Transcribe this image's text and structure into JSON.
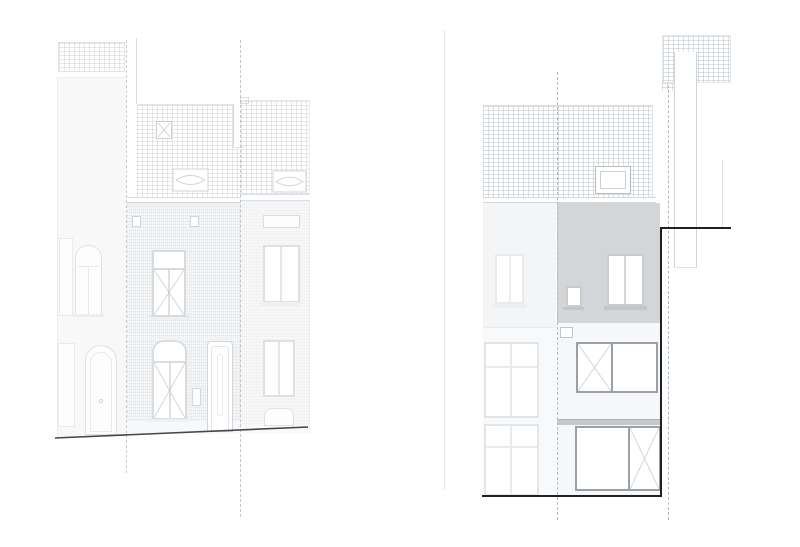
{
  "drawing": {
    "kind": "architectural-elevations",
    "views": [
      {
        "id": "street-elevation",
        "depicts": [
          "neighbor-house-left",
          "row-house-centre",
          "row-house-right",
          "tiled-roofs",
          "roof-window",
          "lens-dormer",
          "roof-chimney",
          "arched-windows",
          "entry-doors",
          "sloping-street-line",
          "dashed-parcel-boundaries"
        ]
      },
      {
        "id": "rear-elevation",
        "depicts": [
          "neighbor-brick-facade",
          "grey-rendered-upper-facade",
          "roof-skylight",
          "chimney-stack",
          "new-window-openings",
          "bold-extension-outline",
          "flat-ground-line",
          "dashed-parcel-boundaries"
        ]
      }
    ]
  },
  "colors": {
    "paper": "#ffffff",
    "tile-line": "#98a2aa52",
    "brick-line": "#98a2aa38",
    "faint-line": "#98a2aa1a",
    "edge": "#d9dcde",
    "edge-strong": "#c2c6c9",
    "frame-gray": "#9aa0a5",
    "render-gray": "#d4d5d6",
    "band-gray": "#c6c9cb",
    "sill-gray": "#c3c6c8",
    "glass-diag": "#bcc2c6",
    "ink": "#1f2022",
    "ground": "#45474a",
    "dash": "#b4b9bd",
    "facade-a": "#f8f8f9",
    "facade-b": "#f7f8f9",
    "facade-d": "#f4f5f6"
  }
}
